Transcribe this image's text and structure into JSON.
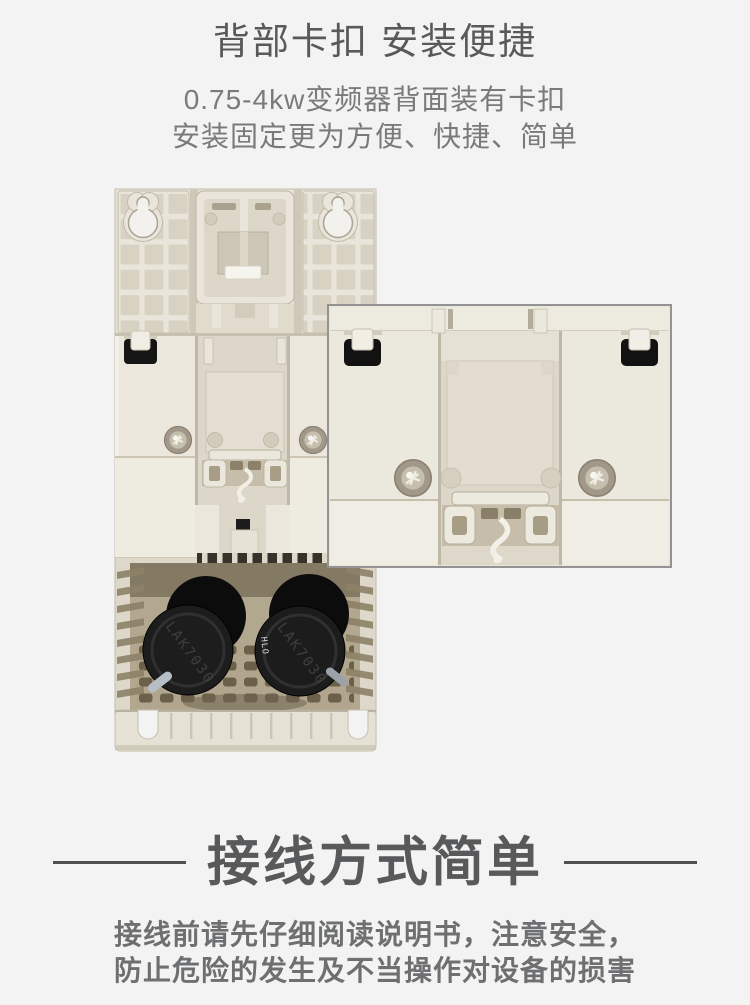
{
  "clip_section": {
    "title": "背部卡扣 安装便捷",
    "desc_line1": "0.75-4kw变频器背面装有卡扣",
    "desc_line2": "安装固定更为方便、快捷、简单"
  },
  "figure": {
    "capacitor_left_label": "LAK7030",
    "capacitor_right_label": "LAK7030",
    "capacitor_right_small_label": "HLO"
  },
  "wiring_section": {
    "title": "接线方式简单",
    "desc_line1": "接线前请先仔细阅读说明书，注意安全，",
    "desc_line2": "防止危险的发生及不当操作对设备的损害"
  },
  "colors": {
    "page_bg": "#f3f3f3",
    "heading_color": "#58595b",
    "subheading_color": "#797a7c",
    "body_text_color": "#6e6f71",
    "divider_color": "#4f5052",
    "plastic_light": "#e9e5da",
    "clip_black": "#141414",
    "inset_border": "#939393"
  }
}
